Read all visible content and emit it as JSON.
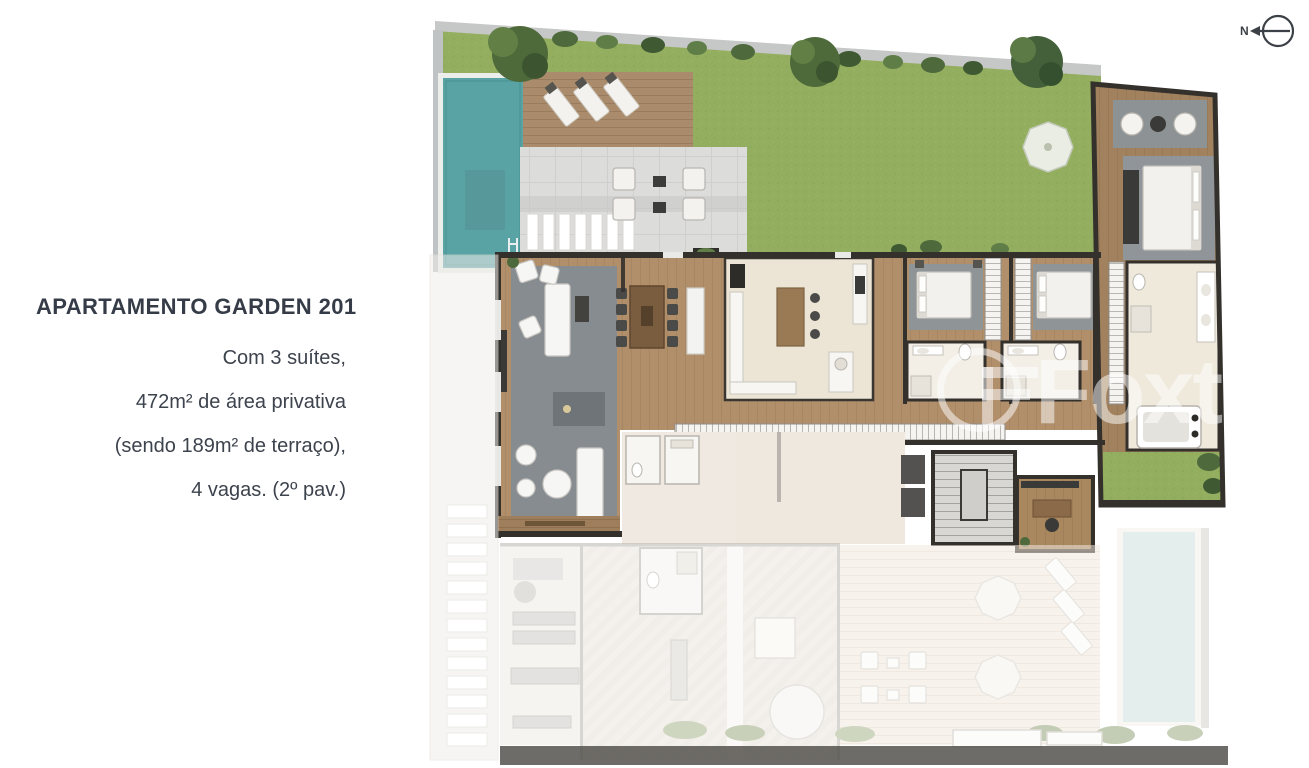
{
  "info_panel": {
    "title": "APARTAMENTO GARDEN 201",
    "lines": [
      "Com 3 suítes,",
      "472m² de área privativa",
      "(sendo 189m² de terraço),",
      "4 vagas. (2º pav.)"
    ]
  },
  "watermark": {
    "text": "Foxter"
  },
  "compass": {
    "label": "N"
  },
  "colors": {
    "text": "#3d434d",
    "lawn": "#93ae5f",
    "pool_water": "#5aa3a4",
    "deck_wood": "#aa8b6b",
    "interior_wood": "#b28f6b",
    "dark_wall": "#34312d",
    "boundary_wall": "#c6c8c7",
    "faded_pool": "#d3e5e1",
    "watermark_white": "rgba(255,255,255,0.5)"
  }
}
